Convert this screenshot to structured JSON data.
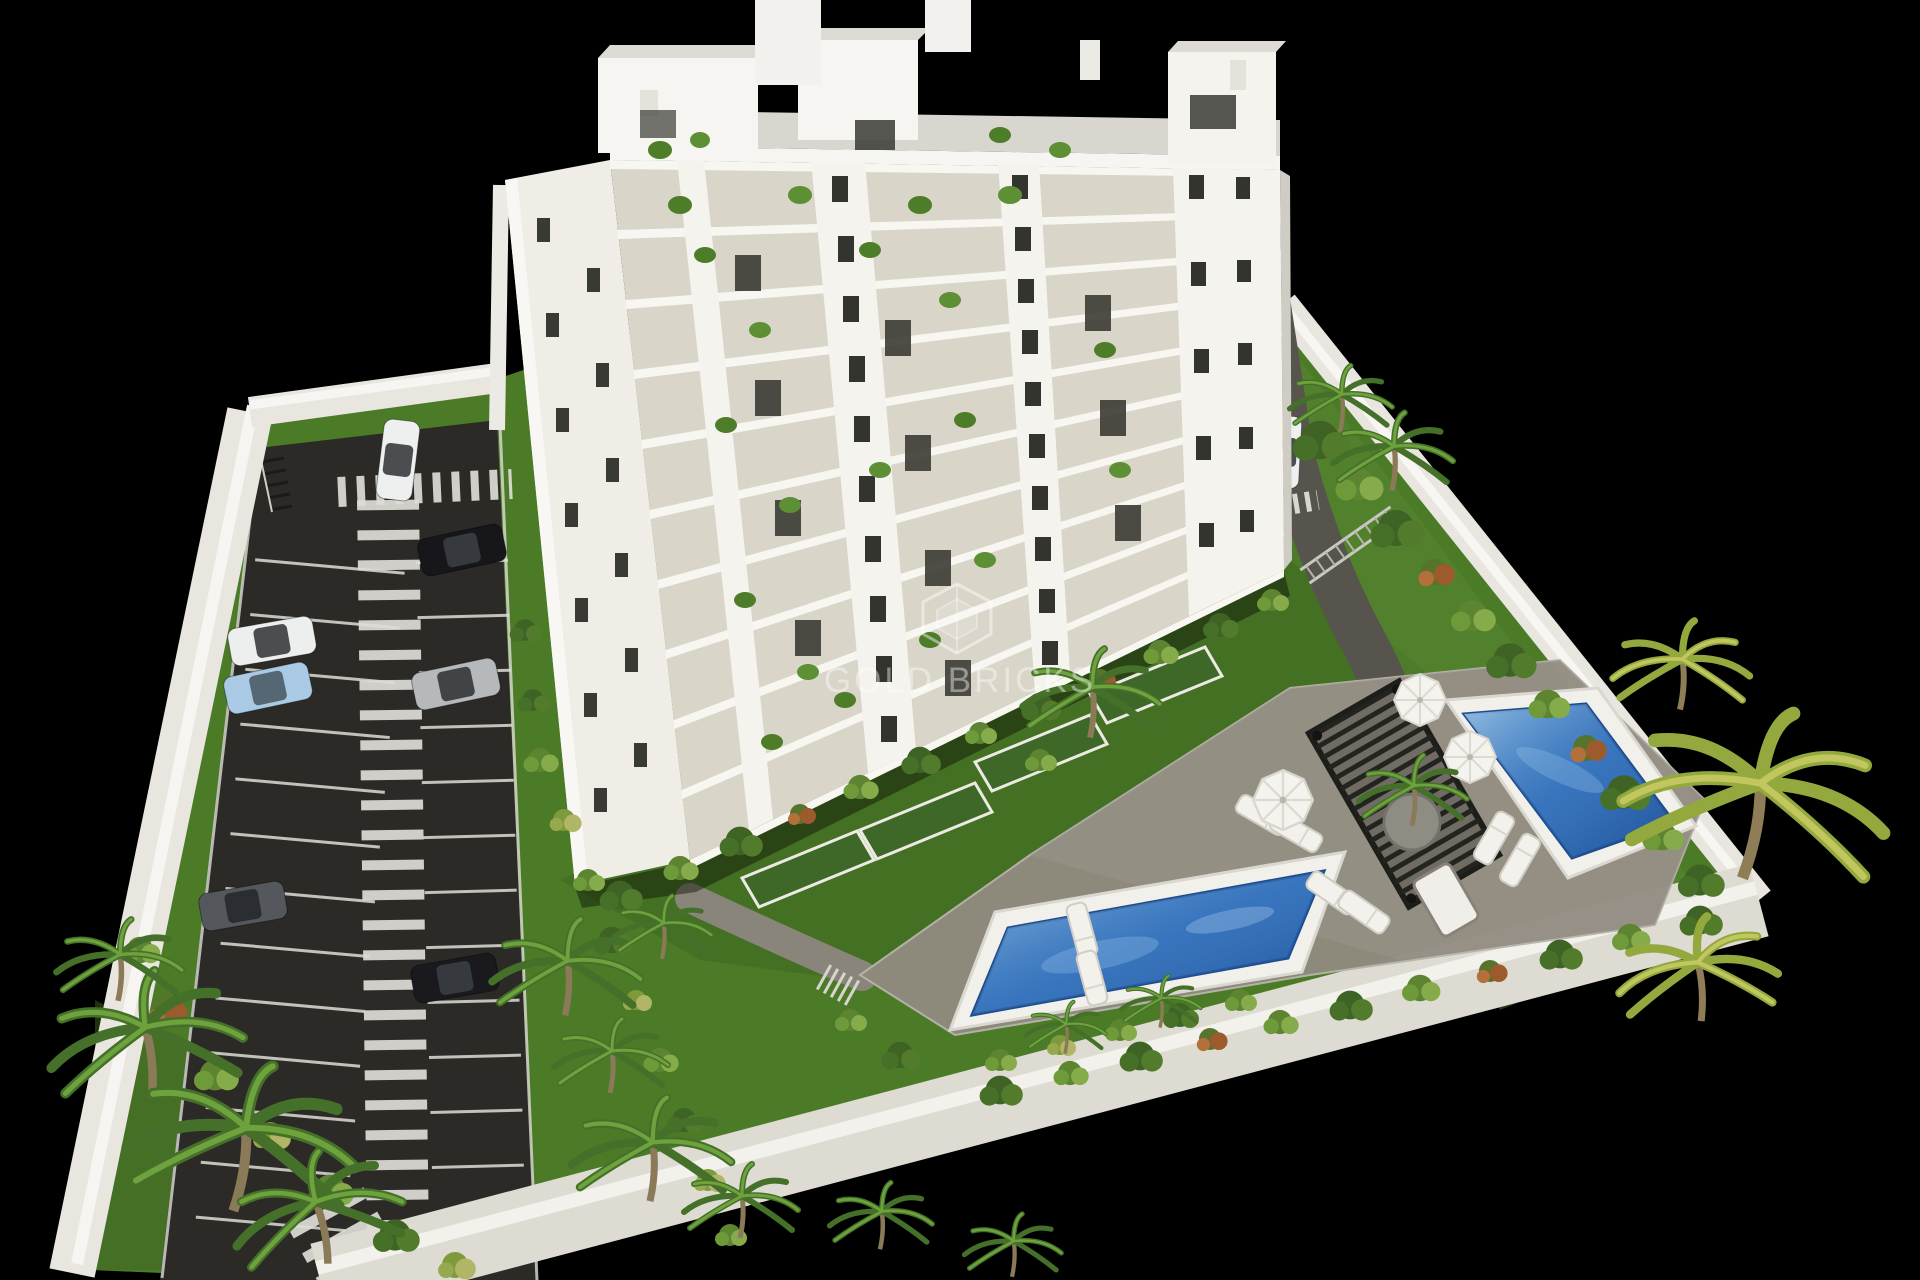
{
  "alt": "3D aerial architectural rendering of a white residential apartment block with balconies, landscaped gardens, two swimming pools, a pergola sun deck and a private parking lot, enclosed by white perimeter walls on a black background",
  "watermark": {
    "text": "GOLD BRICKS",
    "logo": "gold-bricks-shield-icon"
  },
  "palette": {
    "background": "#000000",
    "building_white": "#f5f3ee",
    "balcony_recess": "#d9d5c9",
    "wall": "#e8e6df",
    "asphalt": "#2c2a27",
    "marking": "#dddcd6",
    "grass": "#4c7b28",
    "grass_dark": "#3c6420",
    "patio": "#908a7e",
    "path": "#8a857b",
    "pool_deck": "#f1f0ea",
    "pool_water": "#2f6cb8",
    "pergola": "#23231f",
    "foliage": "#4e7d2a",
    "foliage_light": "#6da23c"
  },
  "cars": [
    {
      "color": "#eef0ef"
    },
    {
      "color": "#17171b"
    },
    {
      "color": "#edefee"
    },
    {
      "color": "#a9c9e4"
    },
    {
      "color": "#54575b"
    },
    {
      "color": "#b6b9bc"
    },
    {
      "color": "#1a1a1e"
    },
    {
      "color": "#eef0ee"
    }
  ],
  "pools": {
    "count": 2
  }
}
